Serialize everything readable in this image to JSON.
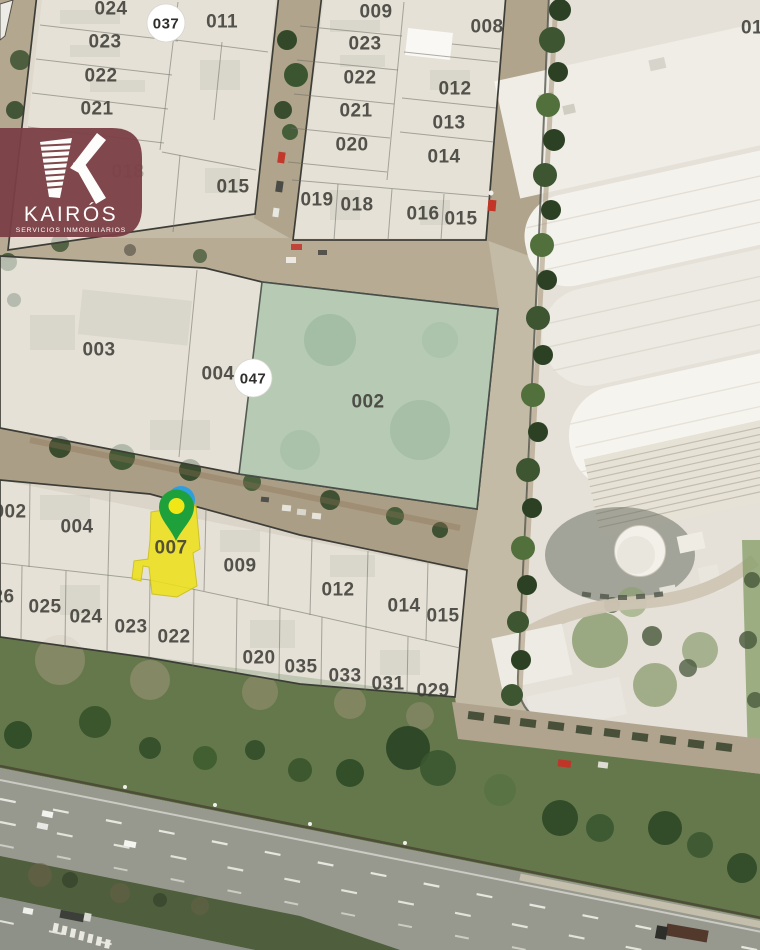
{
  "brand": {
    "name": "KAIRÓS",
    "tagline": "SERVICIOS INMOBILIARIOS",
    "monogram": "K",
    "color": "#7b4046"
  },
  "map": {
    "badges": [
      {
        "label": "037"
      },
      {
        "label": "047"
      }
    ],
    "highlighted_parcel": {
      "label": "007",
      "fill": "#eee217"
    },
    "green_parcel": {
      "label": "002",
      "fill": "#b3c9b2"
    },
    "pin": {
      "blue": "#2f9ede",
      "green": "#1ea13b",
      "yellow": "#f2e716"
    },
    "labels": [
      {
        "t": "024",
        "x": 111,
        "y": 9
      },
      {
        "t": "011",
        "x": 222,
        "y": 22
      },
      {
        "t": "023",
        "x": 105,
        "y": 42
      },
      {
        "t": "022",
        "x": 101,
        "y": 76
      },
      {
        "t": "021",
        "x": 97,
        "y": 109
      },
      {
        "t": "018",
        "x": 128,
        "y": 172,
        "v": "faded"
      },
      {
        "t": "015",
        "x": 233,
        "y": 187
      },
      {
        "t": "009",
        "x": 376,
        "y": 12
      },
      {
        "t": "008",
        "x": 487,
        "y": 27
      },
      {
        "t": "023",
        "x": 365,
        "y": 44
      },
      {
        "t": "022",
        "x": 360,
        "y": 78
      },
      {
        "t": "012",
        "x": 455,
        "y": 89
      },
      {
        "t": "021",
        "x": 356,
        "y": 111
      },
      {
        "t": "013",
        "x": 449,
        "y": 123
      },
      {
        "t": "020",
        "x": 352,
        "y": 145
      },
      {
        "t": "014",
        "x": 444,
        "y": 157
      },
      {
        "t": "019",
        "x": 317,
        "y": 200
      },
      {
        "t": "018",
        "x": 357,
        "y": 205
      },
      {
        "t": "016",
        "x": 423,
        "y": 214
      },
      {
        "t": "015",
        "x": 461,
        "y": 219
      },
      {
        "t": "01",
        "x": 752,
        "y": 28
      },
      {
        "t": "003",
        "x": 99,
        "y": 350
      },
      {
        "t": "004",
        "x": 218,
        "y": 374
      },
      {
        "t": "002",
        "x": 368,
        "y": 402
      },
      {
        "t": "002",
        "x": 10,
        "y": 512
      },
      {
        "t": "004",
        "x": 77,
        "y": 527
      },
      {
        "t": "007",
        "x": 171,
        "y": 548
      },
      {
        "t": "009",
        "x": 240,
        "y": 566
      },
      {
        "t": "012",
        "x": 338,
        "y": 590
      },
      {
        "t": "014",
        "x": 404,
        "y": 606
      },
      {
        "t": "015",
        "x": 443,
        "y": 616
      },
      {
        "t": "026",
        "x": -2,
        "y": 597
      },
      {
        "t": "025",
        "x": 45,
        "y": 607
      },
      {
        "t": "024",
        "x": 86,
        "y": 617
      },
      {
        "t": "023",
        "x": 131,
        "y": 627
      },
      {
        "t": "022",
        "x": 174,
        "y": 637
      },
      {
        "t": "020",
        "x": 259,
        "y": 658
      },
      {
        "t": "035",
        "x": 301,
        "y": 667
      },
      {
        "t": "033",
        "x": 345,
        "y": 676
      },
      {
        "t": "031",
        "x": 388,
        "y": 684
      },
      {
        "t": "029",
        "x": 433,
        "y": 691
      }
    ]
  }
}
